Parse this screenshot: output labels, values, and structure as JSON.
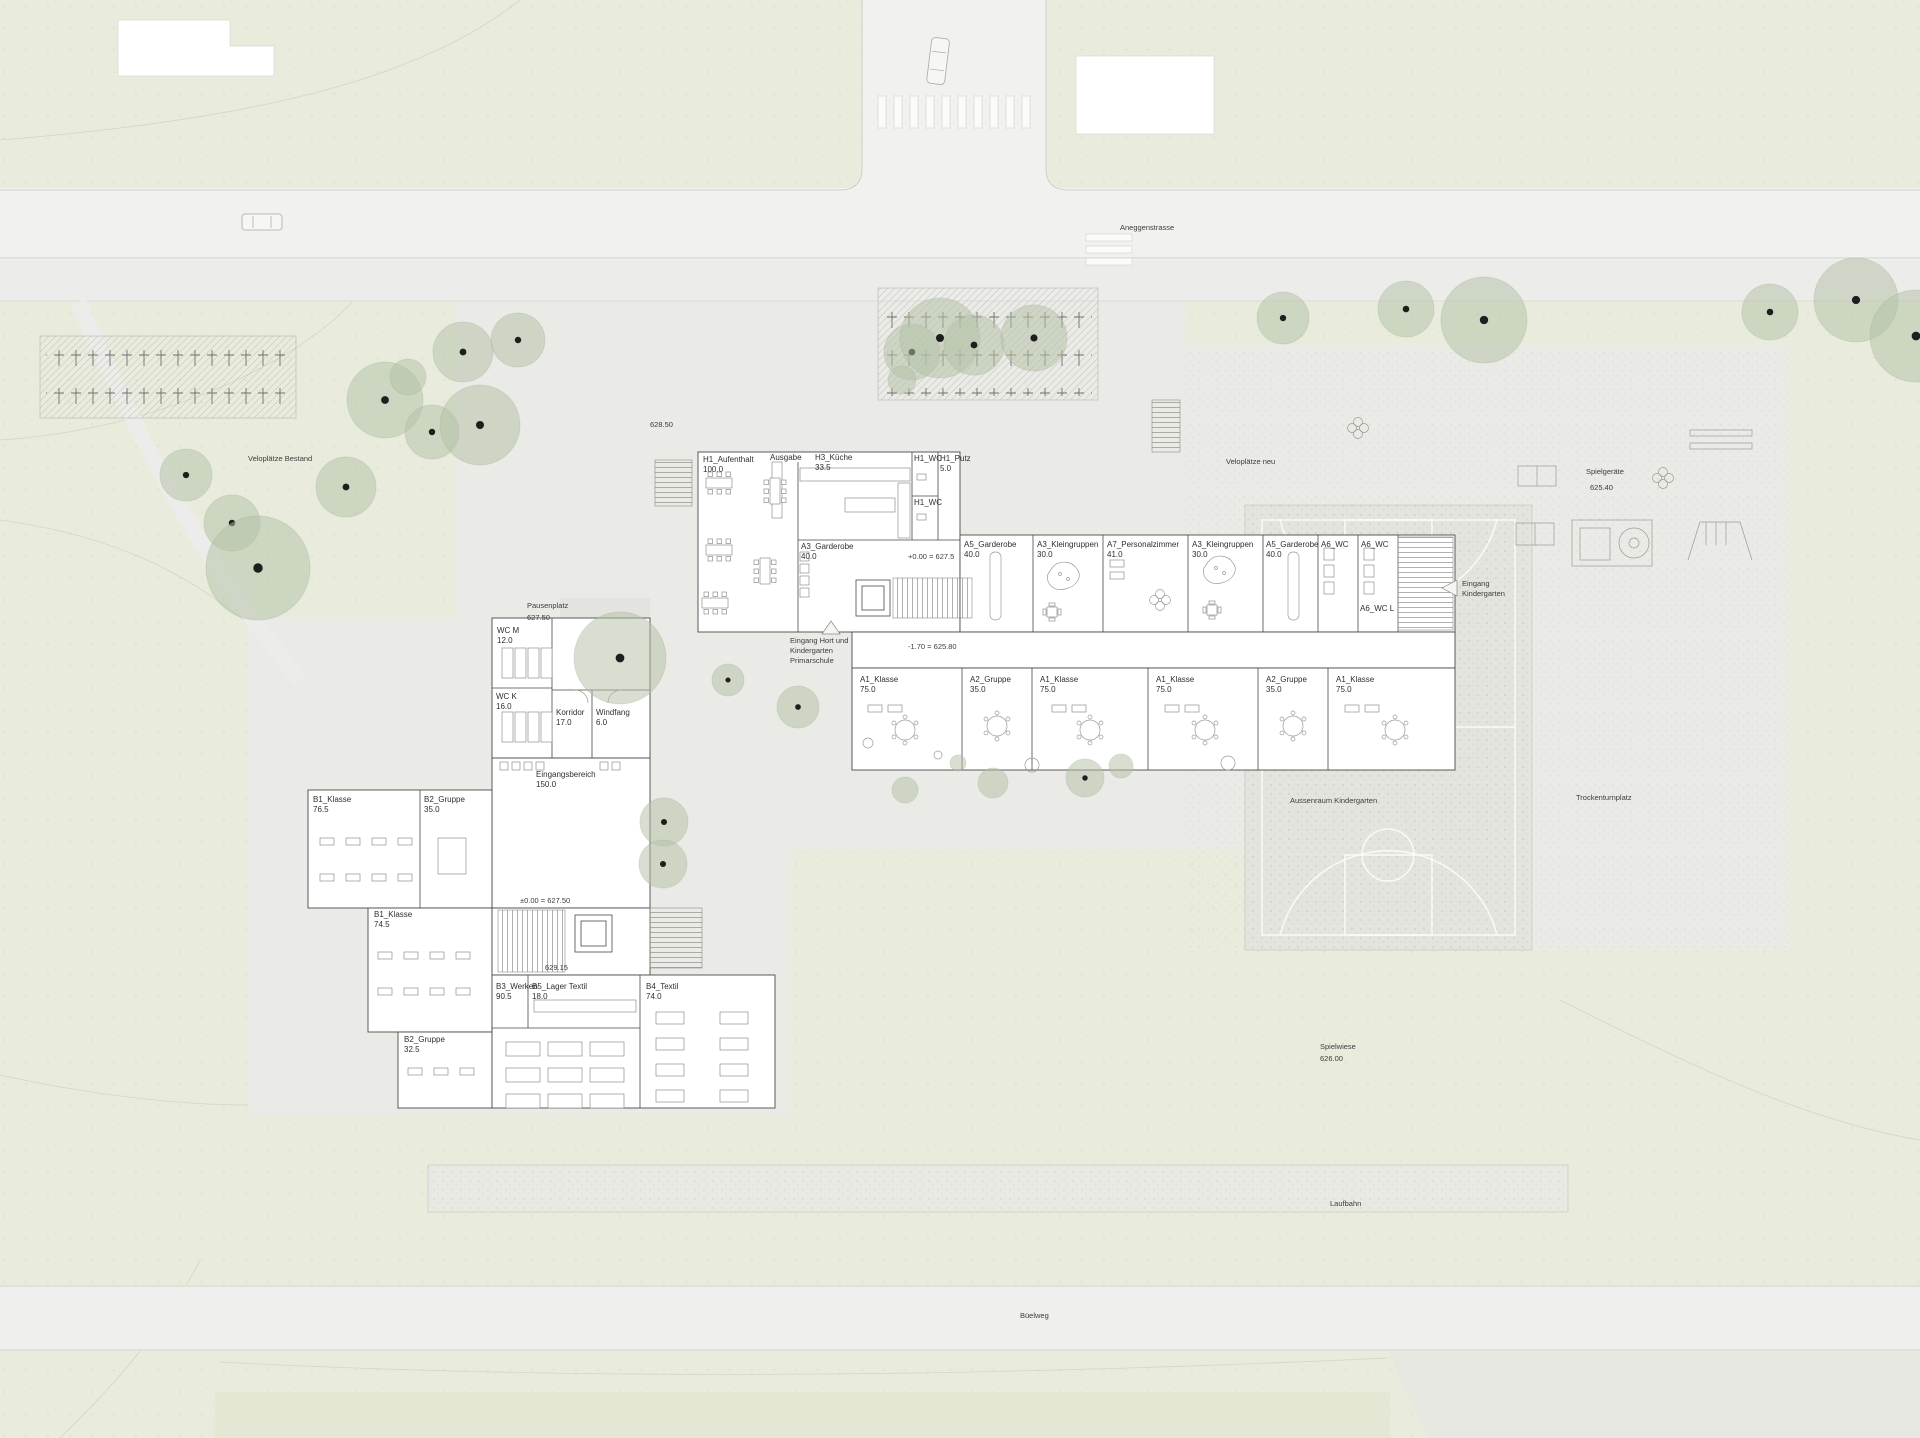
{
  "labels": {
    "street_top": "Aneggenstrasse",
    "street_bottom": "Büelweg",
    "velo_bestand": "Veloplätze Bestand",
    "velo_neu": "Veloplätze neu",
    "spielgeraete": "Spielgeräte",
    "spielgeraete_elev": "625.40",
    "eingang_kiga_1": "Eingang",
    "eingang_kiga_2": "Kindergarten",
    "aussenraum": "Aussenraum Kindergarten",
    "trockenturnplatz": "Trockenturnplatz",
    "spielwiese": "Spielwiese",
    "spielwiese_elev": "626.00",
    "laufbahn": "Laufbahn",
    "pausenplatz": "Pausenplatz",
    "pausenplatz_elev": "627.50",
    "spot_elev": "628.50",
    "eingang_hort_1": "Eingang Hort und",
    "eingang_hort_2": "Kindergarten",
    "eingang_hort_3": "Primarschule",
    "elev_entry_upper": "+0.00 = 627.5",
    "elev_lower_upper": "-1.70 = 625.80",
    "elev_entry_school": "±0.00 = 627.50",
    "elev_school_2": "629.15"
  },
  "rooms": {
    "upper": [
      {
        "name": "H1_Aufenthalt",
        "area": "100.0"
      },
      {
        "name": "Ausgabe",
        "area": ""
      },
      {
        "name": "H3_Küche",
        "area": "33.5"
      },
      {
        "name": "H1_WC",
        "area": ""
      },
      {
        "name": "H1_Putz",
        "area": "5.0"
      },
      {
        "name": "H1_WC",
        "area": ""
      },
      {
        "name": "A3_Garderobe",
        "area": "40.0"
      },
      {
        "name": "A5_Garderobe",
        "area": "40.0"
      },
      {
        "name": "A3_Kleingruppen",
        "area": "30.0"
      },
      {
        "name": "A7_Personalzimmer",
        "area": "41.0"
      },
      {
        "name": "A3_Kleingruppen",
        "area": "30.0"
      },
      {
        "name": "A5_Garderobe",
        "area": "40.0"
      },
      {
        "name": "A6_WC",
        "area": ""
      },
      {
        "name": "A6_WC",
        "area": ""
      },
      {
        "name": "A6_WC L",
        "area": ""
      }
    ],
    "classrooms": [
      {
        "name": "A1_Klasse",
        "area": "75.0"
      },
      {
        "name": "A2_Gruppe",
        "area": "35.0"
      },
      {
        "name": "A1_Klasse",
        "area": "75.0"
      },
      {
        "name": "A1_Klasse",
        "area": "75.0"
      },
      {
        "name": "A2_Gruppe",
        "area": "35.0"
      },
      {
        "name": "A1_Klasse",
        "area": "75.0"
      }
    ],
    "lower": [
      {
        "name": "WC M",
        "area": "12.0"
      },
      {
        "name": "WC K",
        "area": "16.0"
      },
      {
        "name": "Korridor",
        "area": "17.0"
      },
      {
        "name": "Windfang",
        "area": "6.0"
      },
      {
        "name": "Eingangsbereich",
        "area": "150.0"
      },
      {
        "name": "B1_Klasse",
        "area": "76.5"
      },
      {
        "name": "B2_Gruppe",
        "area": "35.0"
      },
      {
        "name": "B1_Klasse",
        "area": "74.5"
      },
      {
        "name": "B2_Gruppe",
        "area": "32.5"
      },
      {
        "name": "B3_Werken",
        "area": "90.5"
      },
      {
        "name": "B5_Lager Textil",
        "area": "18.0"
      },
      {
        "name": "B4_Textil",
        "area": "74.0"
      }
    ]
  },
  "colors": {
    "background_green": "#e9ecdd",
    "paving": "#eaeae7",
    "road": "#f1f1ef",
    "court": "#e4e4de",
    "tree": "#b5c2a6",
    "building": "#ffffff",
    "wall": "#4a4a4a",
    "text": "#2f2f2f"
  }
}
